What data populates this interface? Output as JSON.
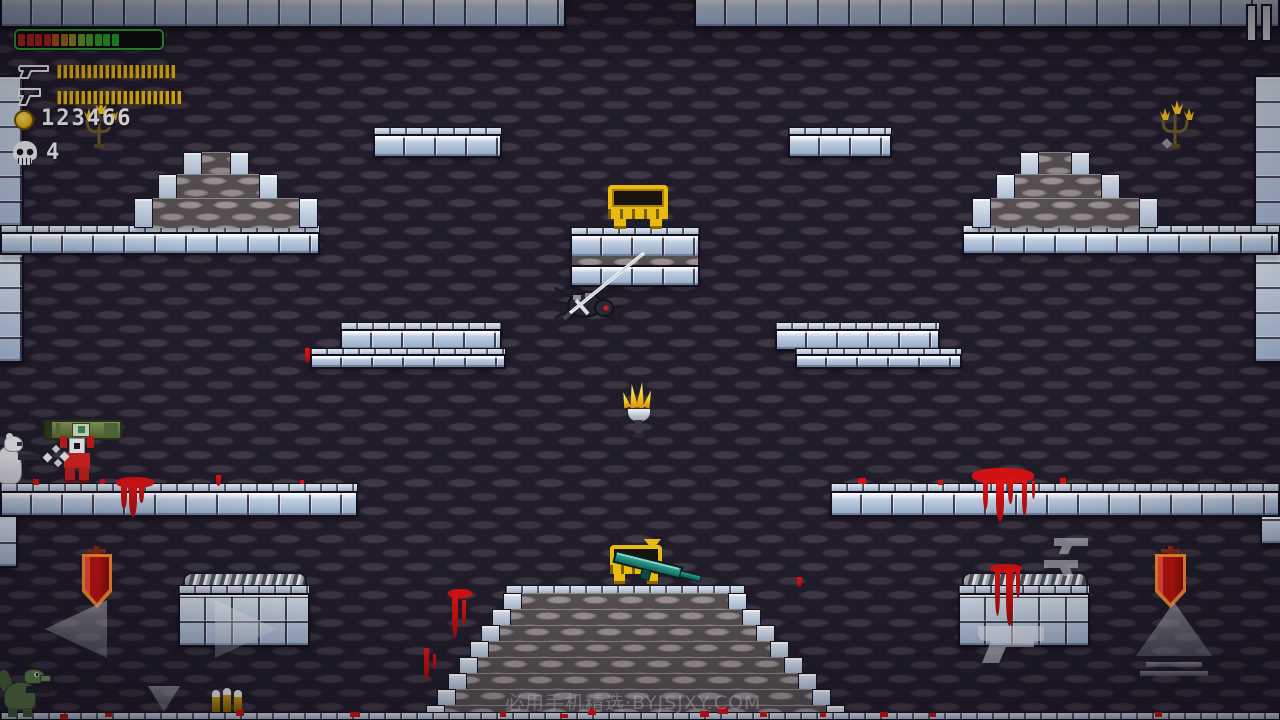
{
  "hud": {
    "health_bar": {
      "border_color": "#35b13a",
      "segment_colors": [
        "#c3241e",
        "#c3241e",
        "#c3241e",
        "#c3241e",
        "#cb5b1c",
        "#b3791b",
        "#a99a1e",
        "#7fae24",
        "#4cb42a",
        "#36b42e",
        "#2fb32c",
        "#2bb22a"
      ]
    },
    "weapons": [
      {
        "icon": "long-gun-icon",
        "ammo_count": 20
      },
      {
        "icon": "pistol-icon",
        "ammo_count": 21
      }
    ],
    "coins": {
      "icon": "coin-icon",
      "value": "123466"
    },
    "kills": {
      "icon": "skull-icon",
      "value": "4"
    }
  },
  "top_bar": {
    "pause_icon": "pause-icon"
  },
  "watermark": {
    "text": "必用手机精选·BYJSJXY.COM"
  },
  "controls": {
    "move_left": "left-arrow-button",
    "move_right": "right-arrow-button",
    "drop_down": "down-arrow-button",
    "jump": "up-arrow-button",
    "fire": "pistol-silhouette-button",
    "swap_weapon": "dual-pistols-button"
  },
  "entities": {
    "player": "red soldier carrying green bazooka",
    "bear_enemy": "white bear firing gun",
    "spider_enemy": "gray spider pierced by sword",
    "lizard_enemy": "green lizard with rifle",
    "treasure_chest_upper": "open gold chest",
    "treasure_chest_lower": "open gold chest with teal rifle",
    "weapon_drop": "teal rifle",
    "drop_indicator": "yellow down arrow",
    "ammo_pickup": "three rifle bullets",
    "torch": "wall torch",
    "candelabra_left": "gold candelabra",
    "candelabra_right": "gold candelabra",
    "banner_left": "red banner",
    "banner_right": "red banner"
  },
  "colors": {
    "wall_brick": "#3a3440",
    "platform_block": "#b3c3da",
    "gold": "#e9ba10",
    "blood": "#d11212",
    "banner_red": "#c2150e",
    "rifle_teal": "#2fa89a",
    "bazooka_green": "#6d8444",
    "health_border": "#35b13a"
  }
}
